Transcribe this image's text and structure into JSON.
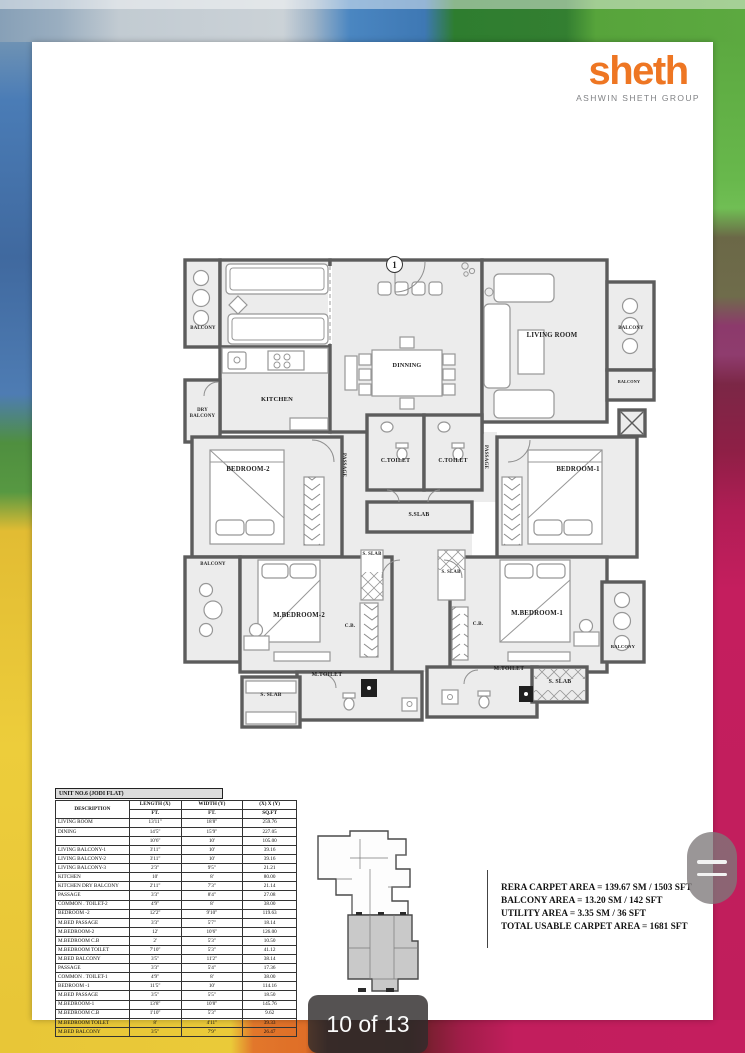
{
  "brand": {
    "logo": "sheth",
    "tagline": "ASHWIN SHETH GROUP",
    "logo_color": "#EE7623",
    "tagline_color": "#808285"
  },
  "viewer": {
    "page_indicator": "10 of 13"
  },
  "plan": {
    "unit_marker": "1",
    "labels": {
      "balcony_top_left": "BALCONY",
      "kitchen": "KITCHEN",
      "dry_balcony": "DRY BALCONY",
      "dinning": "DINNING",
      "living_room": "LIVING ROOM",
      "balcony_right_upper": "BALCONY",
      "balcony_right_lower": "BALCONY",
      "passage_left": "PASSAGE",
      "passage_right": "PASSAGE",
      "c_toilet_left": "C.TOILET",
      "c_toilet_right": "C.TOILET",
      "bedroom_2": "BEDROOM-2",
      "bedroom_1": "BEDROOM-1",
      "s_slab_center": "S.SLAB",
      "s_slab_mid_left": "S. SLAB",
      "s_slab_mid_right": "S. SLAB",
      "balcony_mid_left": "BALCONY",
      "m_bedroom_2": "M.BEDROOM-2",
      "m_bedroom_1": "M.BEDROOM-1",
      "cb_left": "C.B.",
      "cb_right": "C.B.",
      "m_toilet_left": "M.TOILET",
      "m_toilet_right": "M.TOILET",
      "s_slab_bottom_left": "S. SLAB",
      "s_slab_bottom_right": "S. SLAB",
      "balcony_bottom_right": "BALCONY"
    }
  },
  "dim_table": {
    "title": "UNIT NO.6 (JODI FLAT)",
    "col_headers": {
      "description": "DESCRIPTION",
      "length": "LENGTH (X)",
      "length_unit": "FT.",
      "width": "WIDTH (Y)",
      "width_unit": "FT.",
      "area": "(X) X (Y)",
      "area_unit": "SQ.FT"
    },
    "rows": [
      [
        "LIVING ROOM",
        "13'11\"",
        "18'8\"",
        "259.76"
      ],
      [
        "DINING",
        "14'5\"",
        "15'9\"",
        "227.05"
      ],
      [
        "",
        "10'6\"",
        "10'",
        "105.00"
      ],
      [
        "LIVING BALCONY-1",
        "3'11\"",
        "10'",
        "39.16"
      ],
      [
        "LIVING BALCONY-2",
        "3'11\"",
        "10'",
        "39.16"
      ],
      [
        "LIVING BALCONY-3",
        "2'3\"",
        "9'5\"",
        "21.21"
      ],
      [
        "KITCHEN",
        "10'",
        "8'",
        "80.00"
      ],
      [
        "KITCHEN DRY BALCONY",
        "2'11\"",
        "7'3\"",
        "21.14"
      ],
      [
        "PASSAGE",
        "3'3\"",
        "8'4\"",
        "27.08"
      ],
      [
        "COMMON . TOILET-2",
        "4'9\"",
        "8'",
        "38.00"
      ],
      [
        "BEDROOM -2",
        "12'2\"",
        "9'10\"",
        "119.63"
      ],
      [
        "M.BED PASSAGE",
        "3'3\"",
        "5'7\"",
        "18.14"
      ],
      [
        "M.BEDROOM-2",
        "12'",
        "10'6\"",
        "126.00"
      ],
      [
        "M.BEDROOM C.B",
        "2'",
        "5'3\"",
        "10.50"
      ],
      [
        "M.BEDROOM TOILET",
        "7'10\"",
        "5'3\"",
        "41.12"
      ],
      [
        "M.BED BALCONY",
        "3'5\"",
        "11'2\"",
        "38.14"
      ],
      [
        "PASSAGE",
        "3'3\"",
        "5'4\"",
        "17.36"
      ],
      [
        "COMMON . TOILET-1",
        "4'9\"",
        "8'",
        "38.00"
      ],
      [
        "BEDROOM -1",
        "11'5\"",
        "10'",
        "114.16"
      ],
      [
        "M.BED PASSAGE",
        "3'5\"",
        "5'5\"",
        "18.50"
      ],
      [
        "M.BEDROOM-1",
        "13'8\"",
        "10'8\"",
        "145.76"
      ],
      [
        "M.BEDROOM C.B",
        "1'10\"",
        "5'3\"",
        "9.62"
      ],
      [
        "M.BEDROOM TOILET",
        "8'",
        "4'11\"",
        "39.33"
      ],
      [
        "M.BED BALCONY",
        "3'5\"",
        "7'9\"",
        "26.47"
      ]
    ]
  },
  "area_summary": {
    "lines": [
      "RERA CARPET AREA = 139.67 SM / 1503 SFT",
      "BALCONY AREA = 13.20 SM / 142 SFT",
      "UTILITY AREA = 3.35 SM / 36 SFT",
      "TOTAL USABLE CARPET AREA = 1681 SFT"
    ]
  }
}
